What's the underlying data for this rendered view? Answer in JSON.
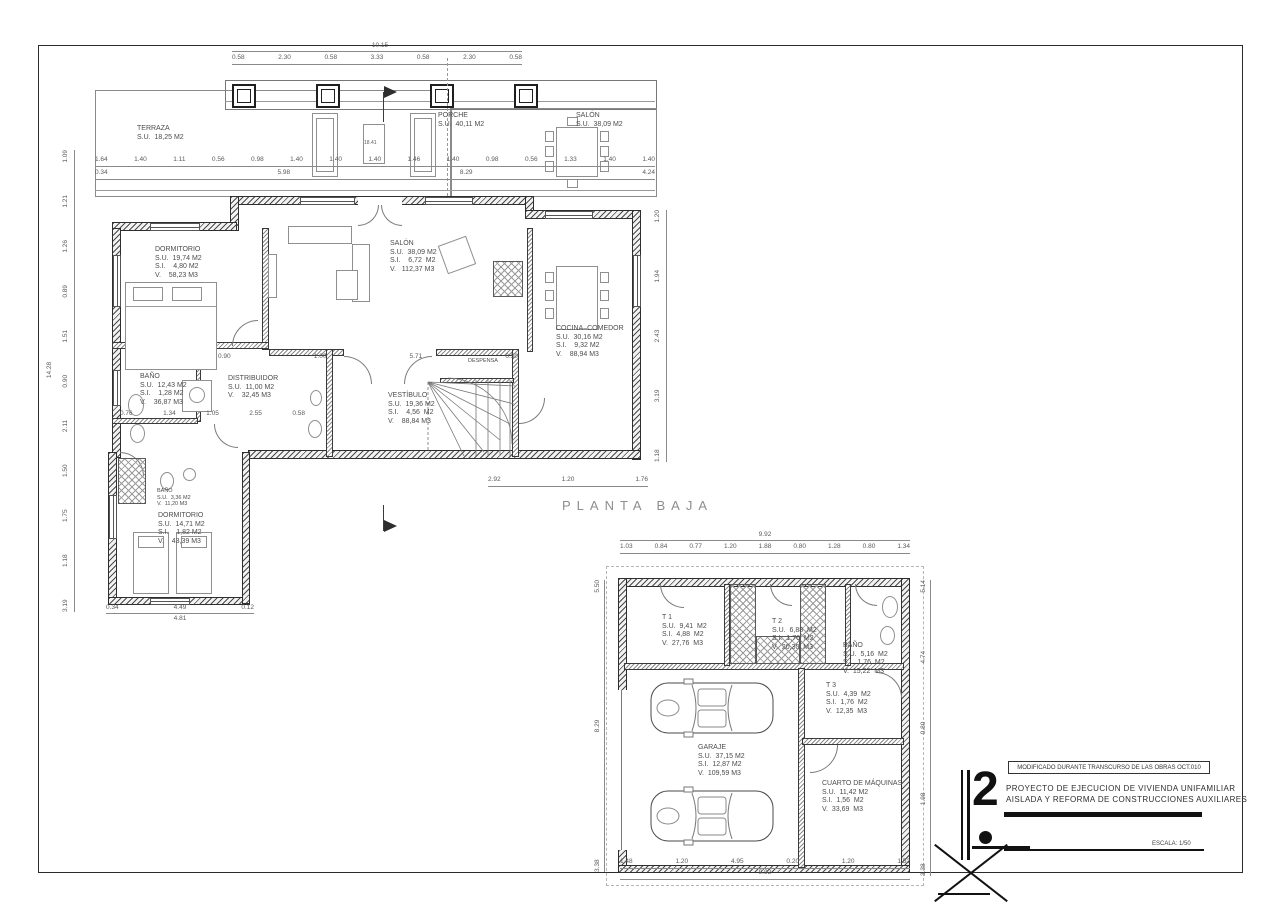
{
  "sheet": {
    "plan_title": "PLANTA BAJA",
    "scale_label": "ESCALA: 1/50",
    "revision_note": "MODIFICADO DURANTE TRANSCURSO DE LAS OBRAS OCT.010",
    "sheet_number": "2",
    "project_title_line1": "PROYECTO DE EJECUCION DE VIVIENDA UNIFAMILIAR",
    "project_title_line2": "AISLADA Y REFORMA DE CONSTRUCCIONES AUXILIARES",
    "section_label": "A",
    "porch_note": "18.41"
  },
  "rooms_main": [
    {
      "name": "TERRAZA",
      "l1": "S.U.  18,25 M2"
    },
    {
      "name": "PORCHE",
      "l1": "S.U.  40,11 M2"
    },
    {
      "name": "SALÓN",
      "l1": "S.U.  38,09 M2"
    },
    {
      "name": "DORMITORIO",
      "l1": "S.U.  19,74 M2",
      "l2": "S.I.    4,80 M2",
      "l3": "V.    58,23 M3"
    },
    {
      "name": "SALÓN",
      "l1": "S.U.  38,09 M2",
      "l2": "S.I.    6,72  M2",
      "l3": "V.   112,37 M3"
    },
    {
      "name": "COCINA–COMEDOR",
      "l1": "S.U.  30,16 M2",
      "l2": "S.I.    9,32 M2",
      "l3": "V.    88,94 M3"
    },
    {
      "name": "BAÑO",
      "l1": "S.U.  12,43 M2",
      "l2": "S.I.    1,28 M2",
      "l3": "V.    36,87 M3"
    },
    {
      "name": "DISTRIBUIDOR",
      "l1": "S.U.  11,00 M2",
      "l2": "V.    32,45 M3"
    },
    {
      "name": "VESTÍBULO",
      "l1": "S.U.  19,36 M2",
      "l2": "S.I.    4,56  M2",
      "l3": "V.    88,84 M3"
    },
    {
      "name": "DESPENSA"
    },
    {
      "name": "BAÑO",
      "l1": "S.U.  3,36 M2",
      "l2": "V.  11,20 M3"
    },
    {
      "name": "DORMITORIO",
      "l1": "S.U.  14,71 M2",
      "l2": "S.I.    1,82 M2",
      "l3": "V.    43,39 M3"
    }
  ],
  "rooms_garage": [
    {
      "name": "T 1",
      "l1": "S.U.  9,41  M2",
      "l2": "S.I.  4,88  M2",
      "l3": "V.  27,76  M3"
    },
    {
      "name": "T 2",
      "l1": "S.U.  6,88  M2",
      "l2": "S.I.  1,76  M2",
      "l3": "V.  20,30  M3"
    },
    {
      "name": "BAÑO",
      "l1": "S.U.  5,16  M2",
      "l2": "S.I.  1,76  M2",
      "l3": "V.  15,22  M3"
    },
    {
      "name": "T 3",
      "l1": "S.U.  4,39  M2",
      "l2": "S.I.  1,76  M2",
      "l3": "V.  12,35  M3"
    },
    {
      "name": "GARAJE",
      "l1": "S.U.  37,15 M2",
      "l2": "S.I.  12,87 M2",
      "l3": "V.  109,59 M3"
    },
    {
      "name": "CUARTO DE MÁQUINAS",
      "l1": "S.U.  11,42 M2",
      "l2": "S.I.  1,56  M2",
      "l3": "V.  33,69  M3"
    }
  ],
  "dims": {
    "top_overall": "10.15",
    "top_segments": "0.58 2.30 0.58 3.33 0.58 2.30 0.58",
    "porch_row1": "1.64 1.40 1.11 0.56 0.98 1.40 1.40 1.40 1.46 1.40 0.98 0.56 1.33 1.40 1.40",
    "porch_row2": "0.34 5.98 8.29 4.24",
    "mid_row": "0.90 1.00 5.71 0.50",
    "distrib_row": "0.76 1.34 1.05 2.55 0.58",
    "bottom_row": "2.92 1.20 1.76",
    "wing_row1": "0.34 4.49 0.12",
    "wing_row2": "4.81",
    "left_col": "3.19 1.18 1.75 1.50 2.11 0.90 1.51 0.89 1.26 1.21 1.09",
    "left_overall": "14.28",
    "right_col": "1.18 3.19 2.43 1.94 1.20",
    "garage_top_overall": "9.92",
    "garage_top_segments": "1.03 0.84 0.77 1.20 1.88 0.80 1.28 0.80 1.34",
    "garage_bottom_segments": "1.48 1.20 4.95 0.20 1.20 1.52",
    "garage_bottom_overall": "9.92",
    "garage_left_col": "3.38 8.29 5.50",
    "garage_right_col": "3.38 1.98 0.80 4.74 5.14"
  }
}
